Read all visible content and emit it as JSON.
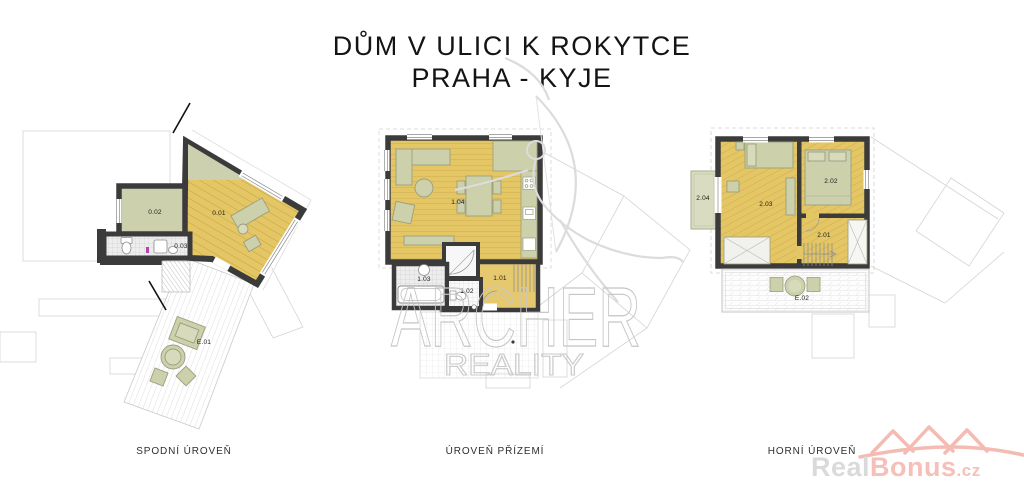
{
  "title": {
    "line1": "DŮM V ULICI K ROKYTCE",
    "line2": "PRAHA - KYJE"
  },
  "plans": {
    "lower": {
      "caption": "SPODNÍ ÚROVEŇ",
      "rooms": {
        "r01": "0.01",
        "r02": "0.02",
        "r03": "0.03",
        "terrace": "E.01"
      }
    },
    "ground": {
      "caption": "ÚROVEŇ PŘÍZEMÍ",
      "rooms": {
        "r01": "1.01",
        "r02": "1.02",
        "r03": "1.03",
        "r04": "1.04"
      }
    },
    "upper": {
      "caption": "HORNÍ ÚROVEŇ",
      "rooms": {
        "r01": "2.01",
        "r02": "2.02",
        "r03": "2.03",
        "r04": "2.04",
        "terrace": "E.02"
      }
    }
  },
  "watermark": {
    "brand": "ARCHER",
    "subtitle": "REALITY"
  },
  "logo": {
    "gray_part": "Real",
    "pink_part": "Bonus",
    "tld": ".cz"
  },
  "colors": {
    "floor_yellow": "#e4c665",
    "furniture_olive": "#ccd0ab",
    "wall_dark": "#3b3b3b",
    "logo_pink": "#f3bbb2",
    "logo_gray": "#dadada",
    "watermark_gray": "#c6c6c6"
  }
}
